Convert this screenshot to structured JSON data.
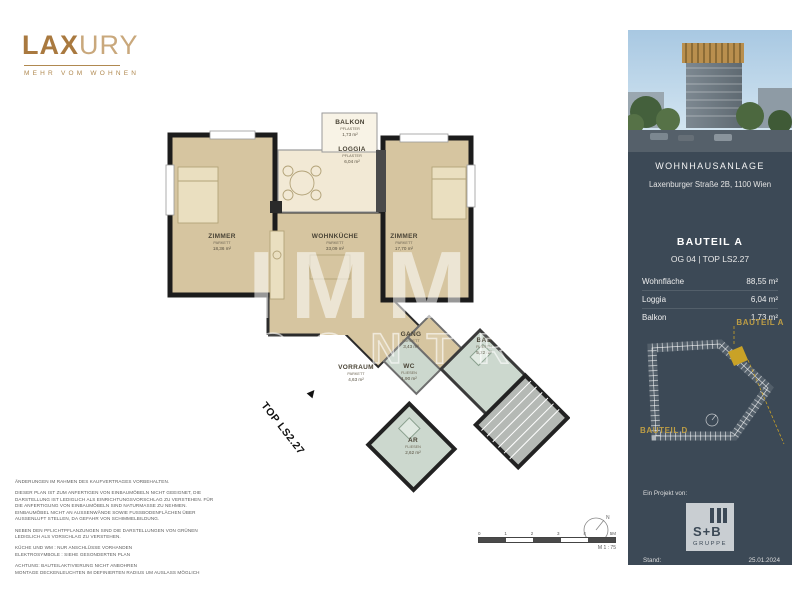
{
  "logo": {
    "lax": "LAX",
    "ury": "URY",
    "tagline": "MEHR VOM WOHNEN"
  },
  "watermark": {
    "line1": "IMMO",
    "line2": "CONTRACT"
  },
  "plan": {
    "unit_label": "TOP LS2.27",
    "north": "N",
    "rooms": [
      {
        "name": "ZIMMER",
        "floor": "PARKETT",
        "area": "18,36 m²"
      },
      {
        "name": "WOHNKÜCHE",
        "floor": "PARKETT",
        "area": "33,09 m²"
      },
      {
        "name": "ZIMMER",
        "floor": "PARKETT",
        "area": "17,70 m²"
      },
      {
        "name": "BALKON",
        "floor": "PFLASTER",
        "area": "1,73 m²"
      },
      {
        "name": "LOGGIA",
        "floor": "PFLASTER",
        "area": "6,04 m²"
      },
      {
        "name": "VORRAUM",
        "floor": "PARKETT",
        "area": "4,63 m²"
      },
      {
        "name": "GANG",
        "floor": "PARKETT",
        "area": "3,43 m²"
      },
      {
        "name": "WC",
        "floor": "FLIESEN",
        "area": "1,90 m²"
      },
      {
        "name": "BAD",
        "floor": "FLIESEN",
        "area": "5,22 m²"
      },
      {
        "name": "AR",
        "floor": "FLIESEN",
        "area": "2,62 m²"
      }
    ],
    "scale": {
      "ticks": [
        "0",
        "1",
        "2",
        "3",
        "4",
        "5M"
      ],
      "label": "M 1 : 75"
    }
  },
  "disclaimer": {
    "p1": "ÄNDERUNGEN IM RAHMEN DES KAUFVERTRAGES VORBEHALTEN.",
    "p2": "DIESER PLAN IST ZUM ANFERTIGEN VON EINBAUMÖBELN NICHT GEEIGNET, DIE DARSTELLUNG IST LEDIGLICH ALS EINRICHTUNGSVORSCHLAG ZU VERSTEHEN. FÜR DIE ANFERTIGUNG VON EINBAUMÖBELN SIND NATURMASSE ZU NEHMEN. EINBAUMÖBEL NICHT AN AUSSENWÄNDE SOWIE FUSSBODENFLÄCHEN ÜBER AUSSENLUFT STELLEN, DA GEFAHR VON SCHIMMELBILDUNG.",
    "p3": "NEBEN DEN PFLICHTPFLANZUNGEN SIND DIE DARSTELLUNGEN VON GRÜNEN LEDIGLICH ALS VORSCHLAG ZU VERSTEHEN.",
    "p4": "KÜCHE UND WM : NUR ANSCHLÜSSE VORHANDEN\nELEKTROSYMBOLE : SIEHE GESONDERTEN PLAN",
    "p5": "ACHTUNG: BAUTEILAKTIVIERUNG NICHT ANBOHREN\nMONTAGE DECKENLEUCHTEN IM DEFINIERTEN RADIUS UM AUSLASS MÖGLICH"
  },
  "sidebar": {
    "project": {
      "title": "WOHNHAUSANLAGE",
      "address": "Laxenburger Straße 2B, 1100 Wien"
    },
    "unit": {
      "bauteil": "BAUTEIL A",
      "top_line": "OG 04 | TOP LS2.27",
      "metrics": [
        {
          "label": "Wohnfläche",
          "value": "88,55 m²"
        },
        {
          "label": "Loggia",
          "value": "6,04 m²"
        },
        {
          "label": "Balkon",
          "value": "1,73 m²"
        }
      ]
    },
    "siteplan": {
      "label_a": "BAUTEIL A",
      "label_d": "BAUTEIL D"
    },
    "footer": {
      "project_by": "Ein Projekt von:",
      "logo_top": "S+B",
      "logo_bottom": "GRUPPE",
      "stand_label": "Stand:",
      "date": "25.01.2024"
    }
  },
  "colors": {
    "accent_gold": "#b08950",
    "sidebar_bg": "#3c4956",
    "siteplan_gold": "#c9a227",
    "room_beige": "#d6c5a0",
    "wet_room": "#ccd8ce"
  }
}
